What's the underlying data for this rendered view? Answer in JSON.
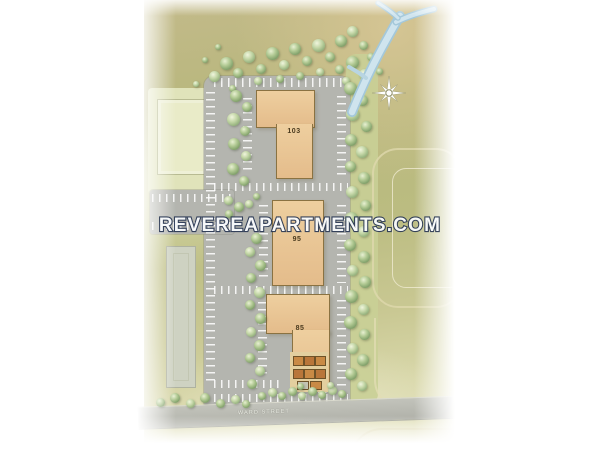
{
  "watermark": {
    "text": "REVEREAPARTMENTS.COM"
  },
  "buildings": {
    "b103": {
      "label": "103"
    },
    "b95": {
      "label": "95"
    },
    "b85": {
      "label": "85"
    }
  },
  "street": {
    "name": "WARD STREET"
  },
  "icons": {
    "tree": "tree-icon",
    "compass": "compass-star-icon",
    "creek": "creek-water"
  },
  "colors": {
    "ground_olive": "#bbbc81",
    "ground_pale": "#e5e3c2",
    "asphalt": "#b4b5af",
    "building_tan": "#e9c79b",
    "building_outline": "#8a7242",
    "tree_green": "#83a26c",
    "creek_blue": "#cfe4ee",
    "neighbor_building": "#ced2c2",
    "parcel_pale": "#e9ebc8",
    "watermark_fill": "#fbfdff",
    "watermark_outline": "#2a3854"
  }
}
